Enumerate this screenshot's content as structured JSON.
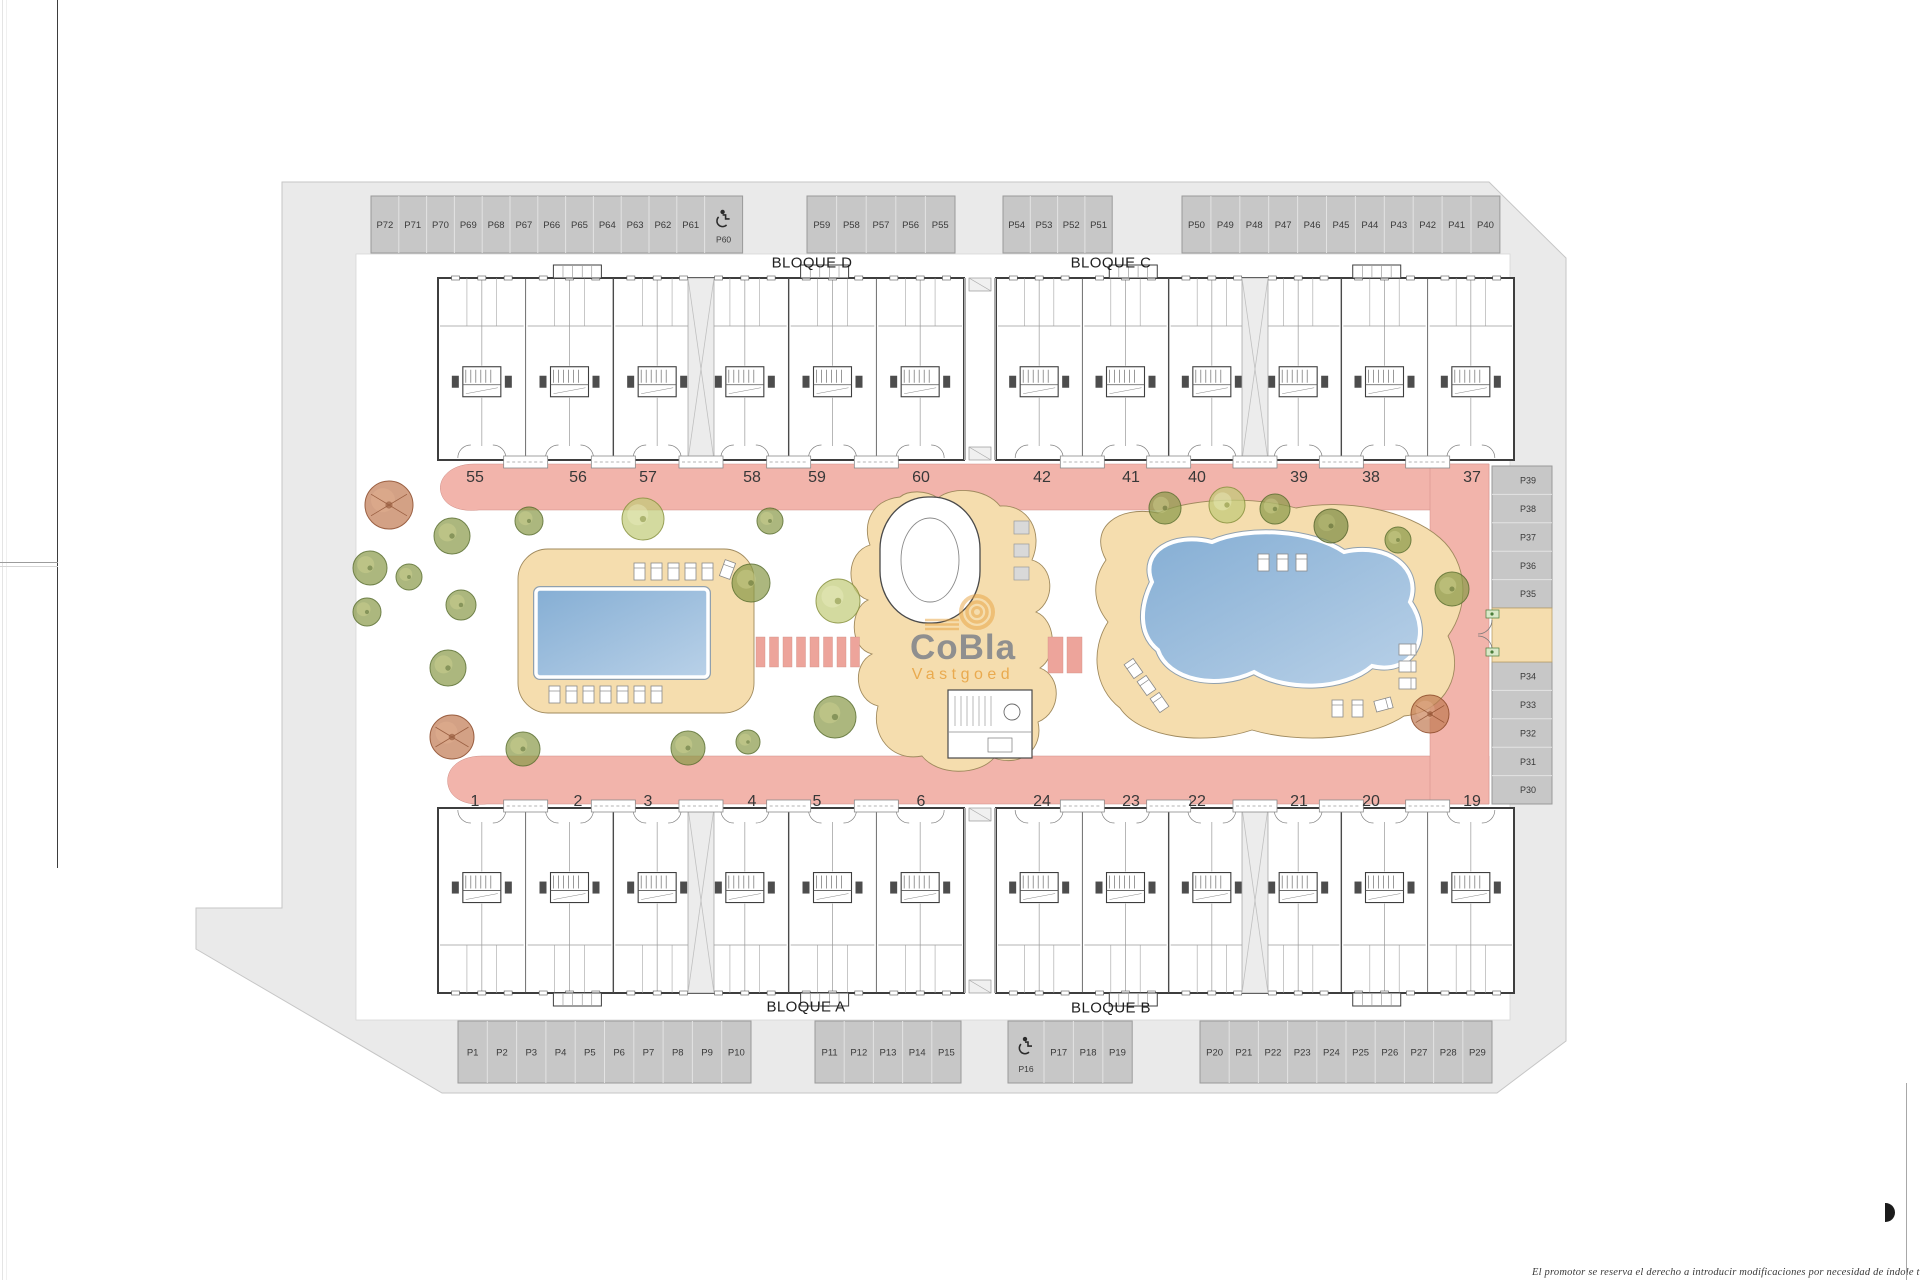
{
  "page": {
    "disclaimer": "El promotor se reserva el derecho a introducir modificaciones por necesidad de índole técnica o legal"
  },
  "watermark": {
    "title": "CoBla",
    "subtitle": "Vastgoed"
  },
  "blocks": [
    {
      "id": "D",
      "label": "BLOQUE D"
    },
    {
      "id": "C",
      "label": "BLOQUE C"
    },
    {
      "id": "A",
      "label": "BLOQUE A"
    },
    {
      "id": "B",
      "label": "BLOQUE B"
    }
  ],
  "unit_numbers": {
    "top_left": [
      "55",
      "56",
      "57",
      "58",
      "59",
      "60"
    ],
    "top_right": [
      "42",
      "41",
      "40",
      "39",
      "38",
      "37"
    ],
    "bottom_left": [
      "1",
      "2",
      "3",
      "4",
      "5",
      "6"
    ],
    "bottom_right": [
      "24",
      "23",
      "22",
      "21",
      "20",
      "19"
    ]
  },
  "parking": {
    "top": [
      {
        "stalls": [
          "P72",
          "P71",
          "P70",
          "P69",
          "P68",
          "P67",
          "P66",
          "P65",
          "P64",
          "P63",
          "P62",
          "P61"
        ],
        "handicap": "P60",
        "handicap_at": "end"
      },
      {
        "stalls": [
          "P59",
          "P58",
          "P57",
          "P56",
          "P55"
        ]
      },
      {
        "stalls": [
          "P54",
          "P53",
          "P52",
          "P51"
        ]
      },
      {
        "stalls": [
          "P50",
          "P49",
          "P48",
          "P47",
          "P46",
          "P45",
          "P44",
          "P43",
          "P42",
          "P41",
          "P40"
        ]
      }
    ],
    "bottom": [
      {
        "stalls": [
          "P1",
          "P2",
          "P3",
          "P4",
          "P5",
          "P6",
          "P7",
          "P8",
          "P9",
          "P10"
        ]
      },
      {
        "stalls": [
          "P11",
          "P12",
          "P13",
          "P14",
          "P15"
        ]
      },
      {
        "stalls": [
          "P17",
          "P18",
          "P19"
        ],
        "handicap": "P16",
        "handicap_at": "start"
      },
      {
        "stalls": [
          "P20",
          "P21",
          "P22",
          "P23",
          "P24",
          "P25",
          "P26",
          "P27",
          "P28",
          "P29"
        ]
      }
    ],
    "right": [
      {
        "stalls": [
          "P39",
          "P38",
          "P37",
          "P36",
          "P35"
        ]
      },
      {
        "stalls": [
          "P34",
          "P33",
          "P32",
          "P31",
          "P30"
        ]
      }
    ]
  },
  "landscape": {
    "trees": [
      {
        "x": 389,
        "y": 505,
        "r": 24,
        "t": "red"
      },
      {
        "x": 370,
        "y": 568,
        "r": 17,
        "t": "green"
      },
      {
        "x": 452,
        "y": 536,
        "r": 18,
        "t": "green"
      },
      {
        "x": 409,
        "y": 577,
        "r": 13,
        "t": "green"
      },
      {
        "x": 461,
        "y": 605,
        "r": 15,
        "t": "green"
      },
      {
        "x": 448,
        "y": 668,
        "r": 18,
        "t": "green"
      },
      {
        "x": 452,
        "y": 737,
        "r": 22,
        "t": "red"
      },
      {
        "x": 523,
        "y": 749,
        "r": 17,
        "t": "green"
      },
      {
        "x": 529,
        "y": 521,
        "r": 14,
        "t": "green"
      },
      {
        "x": 643,
        "y": 519,
        "r": 21,
        "t": "lime"
      },
      {
        "x": 770,
        "y": 521,
        "r": 13,
        "t": "green"
      },
      {
        "x": 751,
        "y": 583,
        "r": 19,
        "t": "green"
      },
      {
        "x": 838,
        "y": 601,
        "r": 22,
        "t": "lime"
      },
      {
        "x": 835,
        "y": 717,
        "r": 21,
        "t": "green"
      },
      {
        "x": 688,
        "y": 748,
        "r": 17,
        "t": "green"
      },
      {
        "x": 748,
        "y": 742,
        "r": 12,
        "t": "green"
      },
      {
        "x": 367,
        "y": 612,
        "r": 14,
        "t": "green"
      },
      {
        "x": 1165,
        "y": 508,
        "r": 16,
        "t": "green"
      },
      {
        "x": 1227,
        "y": 505,
        "r": 18,
        "t": "lime"
      },
      {
        "x": 1275,
        "y": 509,
        "r": 15,
        "t": "green"
      },
      {
        "x": 1331,
        "y": 526,
        "r": 17,
        "t": "olive"
      },
      {
        "x": 1398,
        "y": 540,
        "r": 13,
        "t": "green"
      },
      {
        "x": 1452,
        "y": 589,
        "r": 17,
        "t": "green"
      },
      {
        "x": 1430,
        "y": 714,
        "r": 19,
        "t": "red"
      }
    ]
  },
  "colors": {
    "road_gray": "#eaeaea",
    "parking_fill": "#c7c7c7",
    "walkway_pink": "#f2b4ab",
    "stone_pink": "#eda49b",
    "deck_tan": "#f5ddae",
    "pool_blue": "#85aed4",
    "pool_blue_light": "#b9d1e8",
    "wall_dark": "#3e3e3e",
    "accent_orange": "#e8a23f",
    "logo_gray": "#8f8f8f"
  }
}
